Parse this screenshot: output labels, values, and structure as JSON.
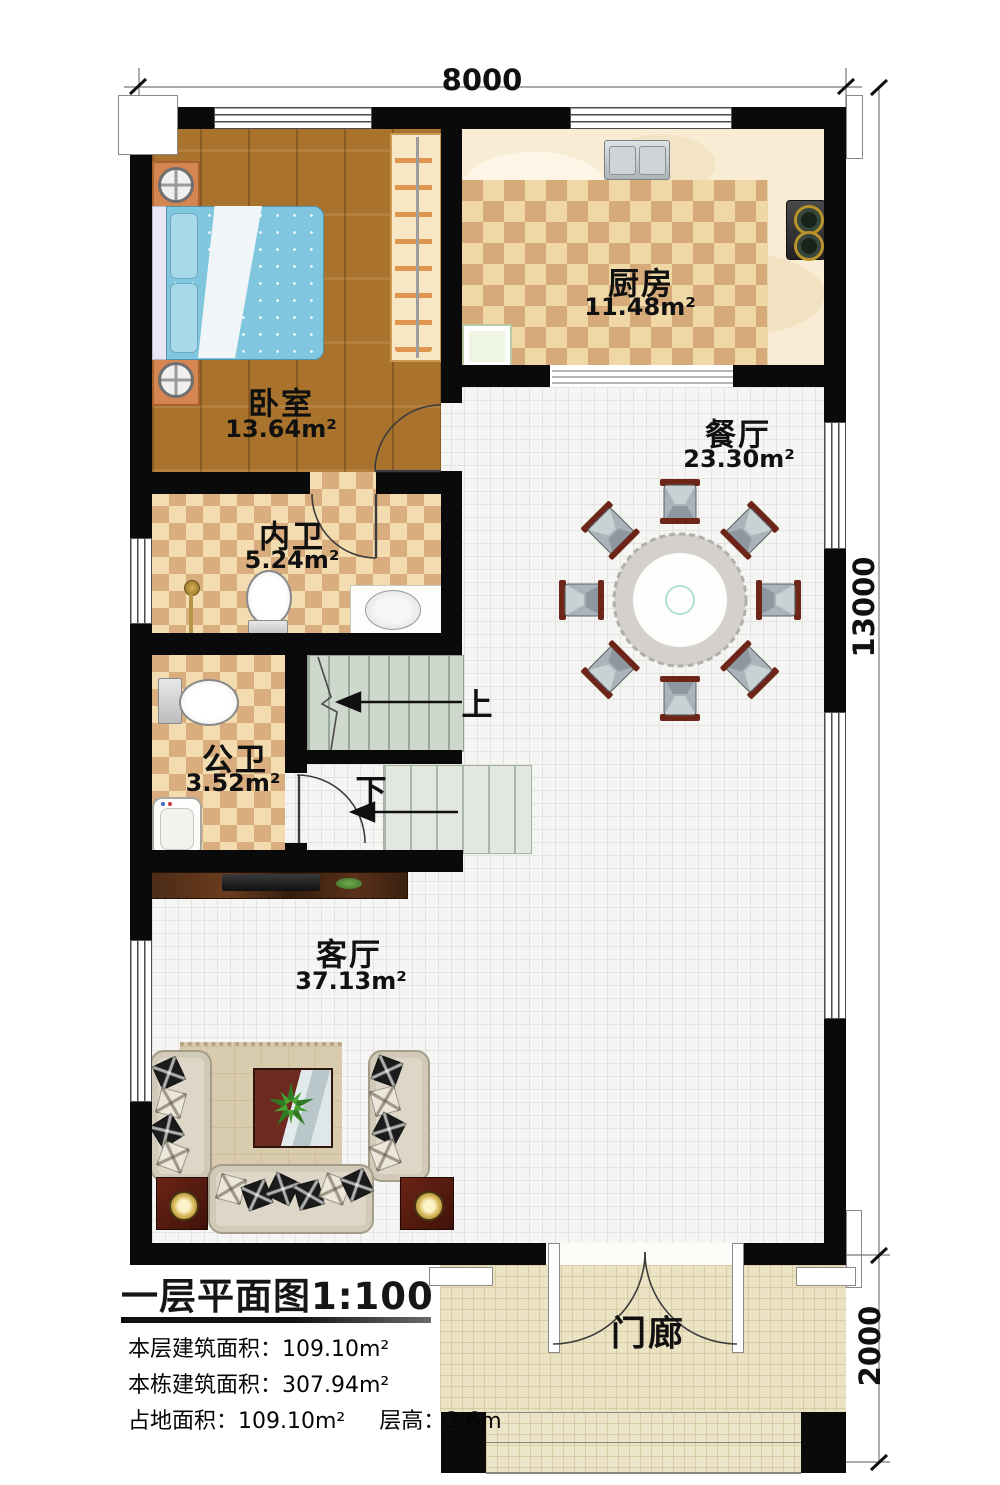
{
  "dimensions": {
    "width_top": "8000",
    "height_main": "13000",
    "height_porch": "2000"
  },
  "rooms": {
    "bedroom": {
      "name": "卧室",
      "area": "13.64m²"
    },
    "kitchen": {
      "name": "厨房",
      "area": "11.48m²"
    },
    "dining": {
      "name": "餐厅",
      "area": "23.30m²"
    },
    "inner_bath": {
      "name": "内卫",
      "area": "5.24m²"
    },
    "public_bath": {
      "name": "公卫",
      "area": "3.52m²"
    },
    "living": {
      "name": "客厅",
      "area": "37.13m²"
    },
    "porch": {
      "name": "门廊"
    }
  },
  "stairs": {
    "up_label": "上",
    "down_label": "下"
  },
  "legend": {
    "title": "一层平面图1:100",
    "stats": [
      {
        "label": "本层建筑面积：",
        "value": "109.10m²"
      },
      {
        "label": "本栋建筑面积：",
        "value": "307.94m²"
      },
      {
        "label": "占地面积：",
        "value": "109.10m²",
        "label2": "层高：",
        "value2": "3.6m"
      }
    ]
  },
  "colors": {
    "wall": "#0a0a0a",
    "wood_floor": "#a9732d",
    "checker_light": "#f3ddb0",
    "checker_dark": "#d9ad7e",
    "tile": "#f5f5f3",
    "stair": "#cfd8cd",
    "porch": "#ebe3c4",
    "chair_frame": "#6e2517",
    "chair_seat": "#a9b3b9"
  }
}
